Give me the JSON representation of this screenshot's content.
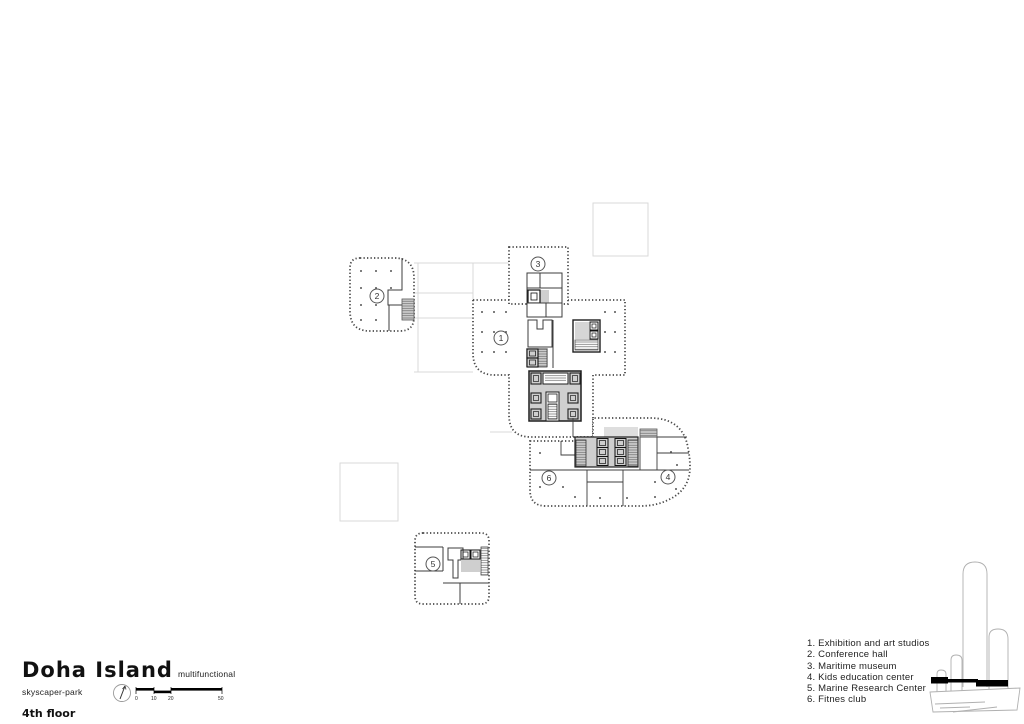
{
  "title_block": {
    "project_title": "Doha Island",
    "project_subtitle": "multifunctional skyscaper-park",
    "floor_label": "4th floor",
    "scale_ticks": [
      "0",
      "10",
      "20",
      "50"
    ]
  },
  "legend": {
    "items": [
      "1. Exhibition and art studios",
      "2. Conference hall",
      "3. Maritime museum",
      "4. Kids education center",
      "5. Marine Research Center",
      "6. Fitnes club"
    ]
  },
  "plan": {
    "zone_numbers": [
      "1",
      "2",
      "3",
      "4",
      "5",
      "6"
    ]
  },
  "icons": {
    "north_arrow": "compass needle",
    "floor_band": "black band marking 4th floor on tower"
  },
  "colors": {
    "plan_line": "#4a4a4a",
    "wall_line": "#3c3c3c",
    "ghost_line": "#d9d9d9",
    "core_fill": "#cfcfcf",
    "floor_band": "#000000",
    "text": "#1a1a1a"
  }
}
